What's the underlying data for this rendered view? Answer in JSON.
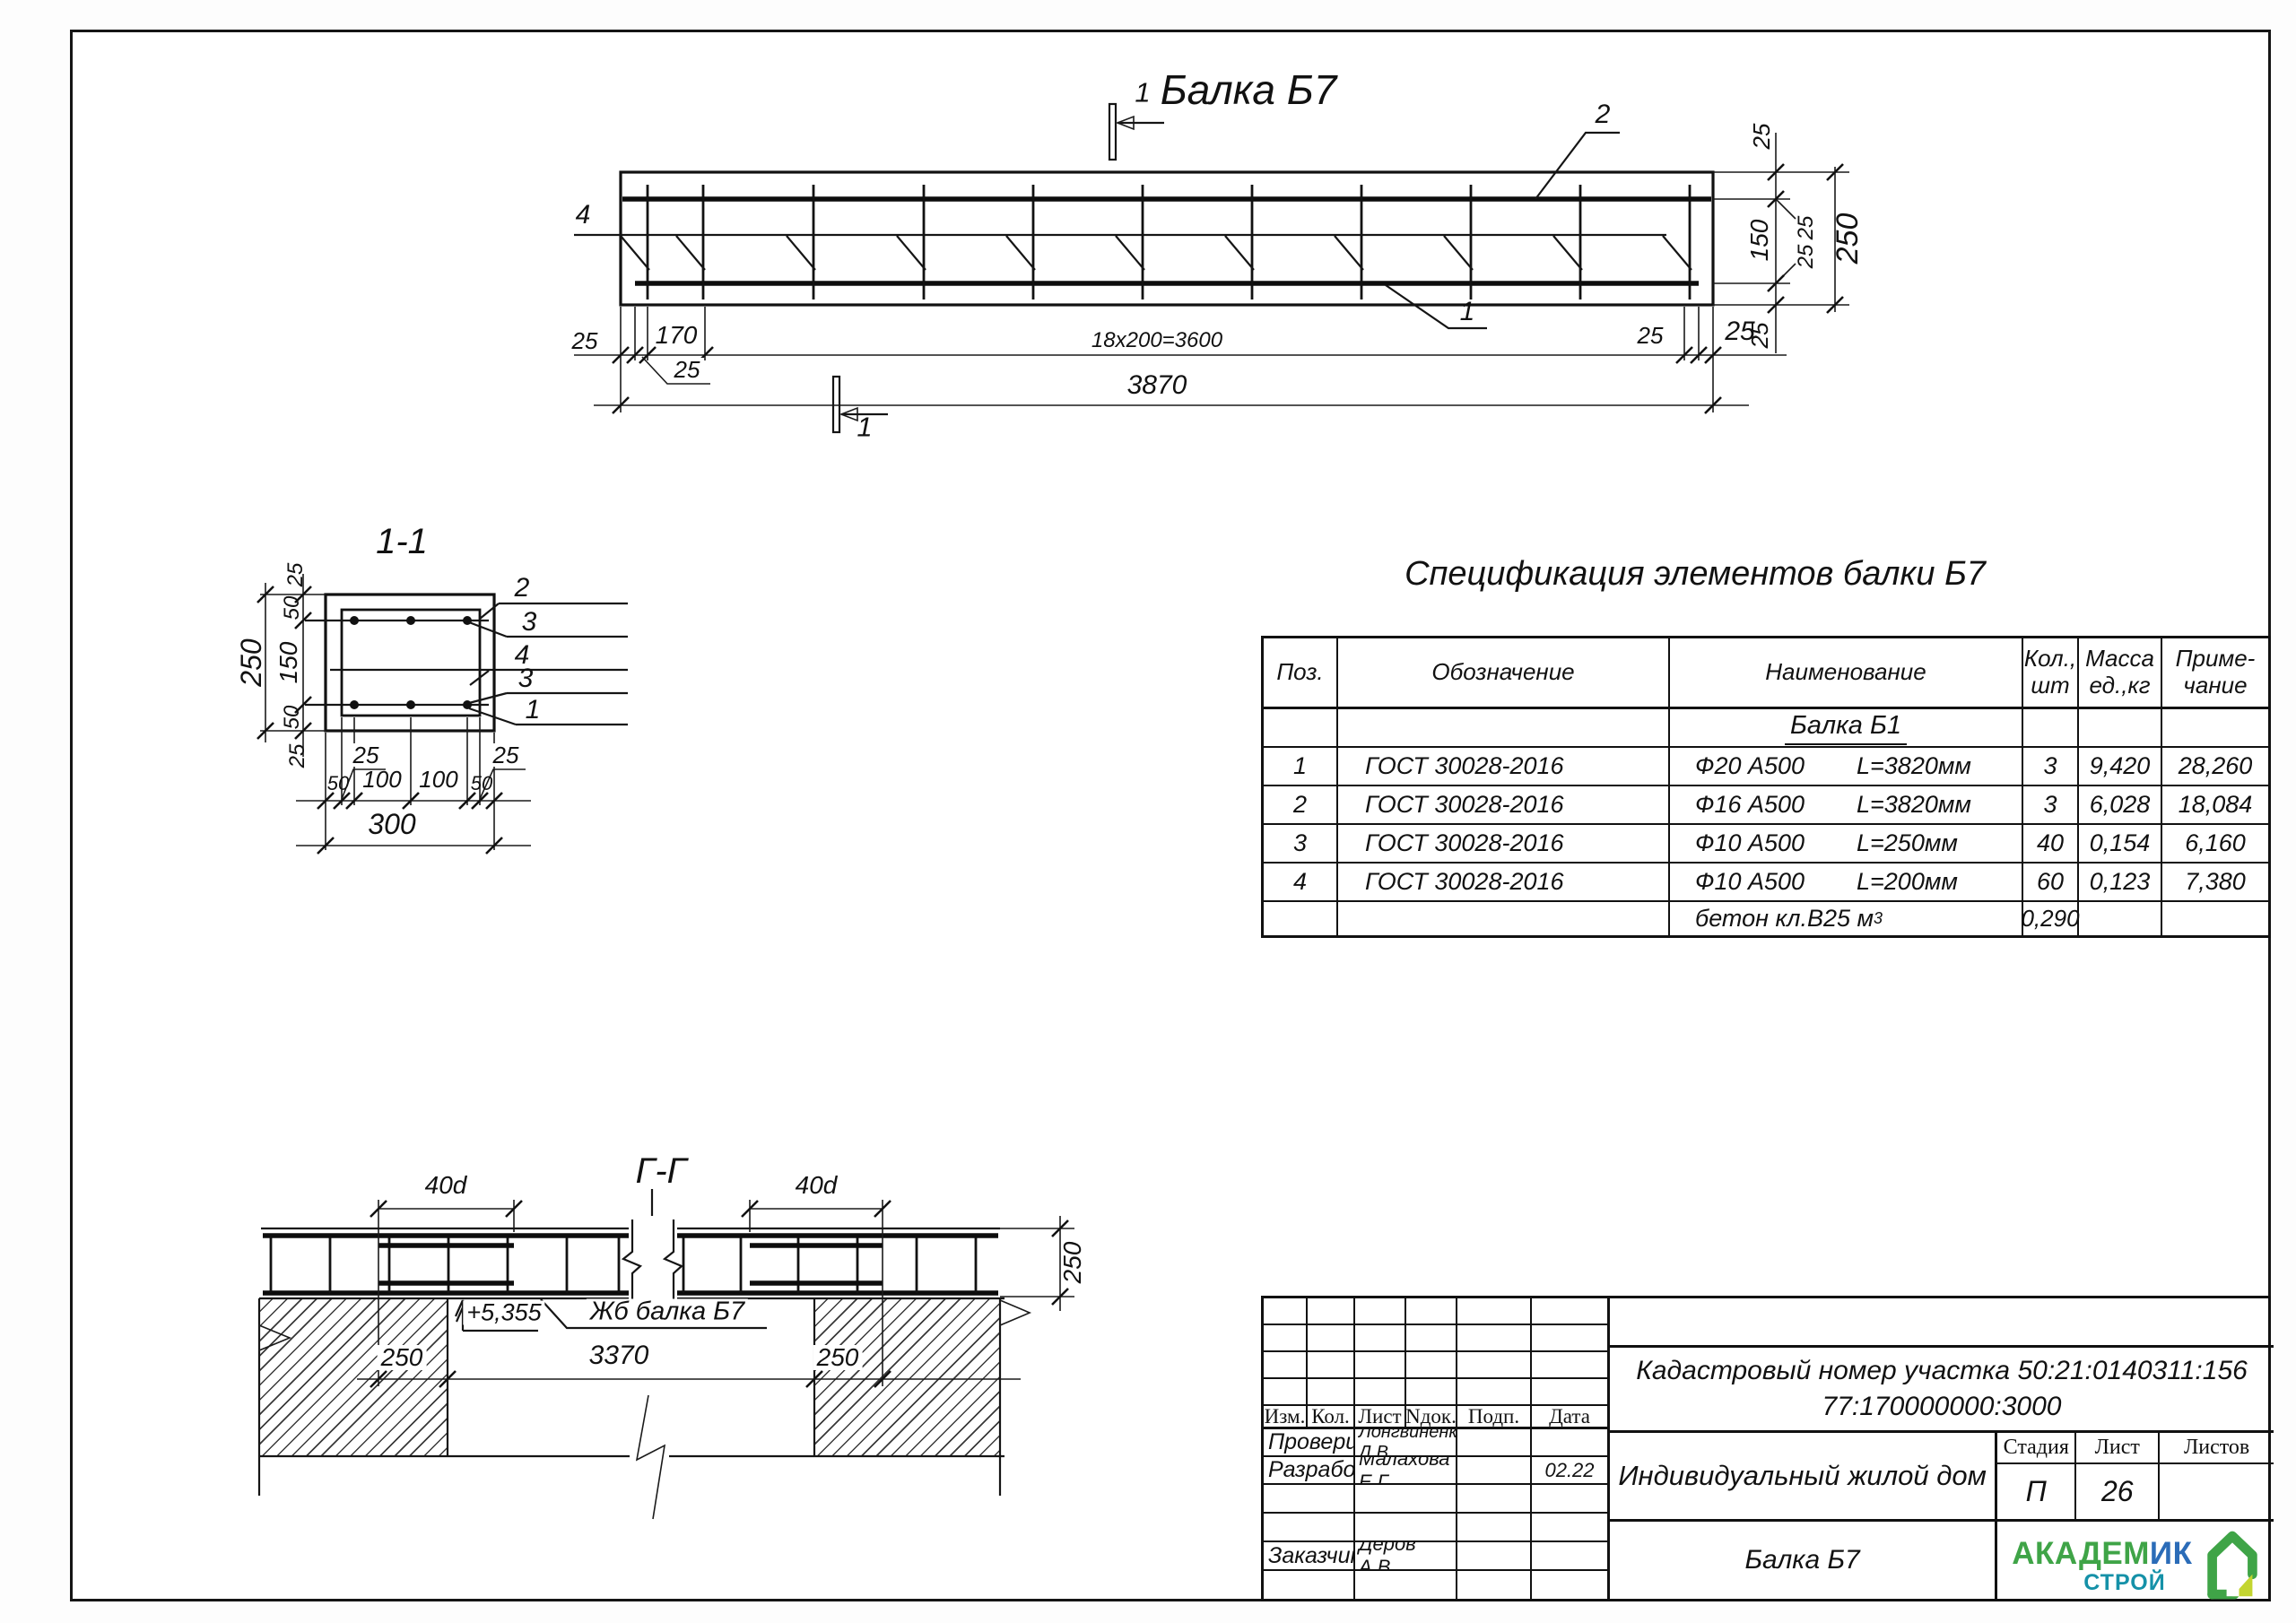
{
  "elevation": {
    "title": "Балка Б7",
    "mark_top": "1",
    "mark_bottom": "1",
    "pos1": "1",
    "pos2": "2",
    "pos4": "4",
    "dim_25_left": "25",
    "dim_170": "170",
    "dim_25_leader": "25",
    "dim_spacing": "18x200=3600",
    "dim_25_right": "25",
    "dim_25_far": "25",
    "dim_total": "3870",
    "rdim_25_above": "25",
    "rdim_25_top": "25",
    "rdim_150": "150",
    "rdim_25_bot": "25",
    "rdim_250": "250",
    "rdim_25_below": "25"
  },
  "section11": {
    "title": "1-1",
    "pos2": "2",
    "pos3a": "3",
    "pos4": "4",
    "pos3b": "3",
    "pos1": "1",
    "left_25_top": "25",
    "left_50_top": "50",
    "left_150": "150",
    "left_50_bot": "50",
    "left_25_bot": "25",
    "left_250": "250",
    "bot_25_left": "25",
    "bot_50_left": "50",
    "bot_100_left": "100",
    "bot_100_right": "100",
    "bot_50_right": "50",
    "bot_25_right": "25",
    "bot_300": "300"
  },
  "gg": {
    "title": "Г-Г",
    "dim_40d_left": "40d",
    "dim_40d_right": "40d",
    "dim_250_side": "250",
    "elevation_mark": "+5,355",
    "beam_label": "Жб балка Б7",
    "dim_250_left": "250",
    "dim_3370": "3370",
    "dim_250_right": "250"
  },
  "spec": {
    "title": "Спецификация элементов балки Б7",
    "col_pos": "Поз.",
    "col_designation": "Обозначение",
    "col_name": "Наименование",
    "col_qty_1": "Кол.,",
    "col_qty_2": "шт",
    "col_mass_1": "Масса",
    "col_mass_2": "ед.,кг",
    "col_note_1": "Приме-",
    "col_note_2": "чание",
    "group": "Балка Б1",
    "rows": [
      {
        "pos": "1",
        "designation": "ГОСТ 30028-2016",
        "name": "Ф20 А500",
        "length": "L=3820мм",
        "qty": "3",
        "mass": "9,420",
        "note": "28,260"
      },
      {
        "pos": "2",
        "designation": "ГОСТ 30028-2016",
        "name": "Ф16 А500",
        "length": "L=3820мм",
        "qty": "3",
        "mass": "6,028",
        "note": "18,084"
      },
      {
        "pos": "3",
        "designation": "ГОСТ 30028-2016",
        "name": "Ф10 А500",
        "length": "L=250мм",
        "qty": "40",
        "mass": "0,154",
        "note": "6,160"
      },
      {
        "pos": "4",
        "designation": "ГОСТ 30028-2016",
        "name": "Ф10 А500",
        "length": "L=200мм",
        "qty": "60",
        "mass": "0,123",
        "note": "7,380"
      }
    ],
    "concrete_name": "бетон кл.В25 м",
    "concrete_sup": "3",
    "concrete_qty": "0,290"
  },
  "titleblock": {
    "h_izm": "Изм.",
    "h_kol": "Кол.",
    "h_list": "Лист",
    "h_ndok": "Nдок.",
    "h_podp": "Подп.",
    "h_data": "Дата",
    "checked_role": "Проверил",
    "checked_name": "Лонгвиненко Д.В",
    "developed_role": "Разработал",
    "developed_name": "Малахова Е.Г.",
    "developed_date": "02.22",
    "customer_role": "Заказчик",
    "customer_name": "Деров А.В.",
    "cadastral1": "Кадастровый номер участка 50:21:0140311:156",
    "cadastral2": "77:170000000:3000",
    "project": "Индивидуальный жилой дом",
    "stage_label": "Стадия",
    "sheet_label": "Лист",
    "sheets_label": "Листов",
    "stage": "П",
    "sheet": "26",
    "sheets": "",
    "doc": "Балка Б7"
  },
  "logo": {
    "part1": "АКАДЕМ",
    "part2": "ИК",
    "line2": "СТРОЙ",
    "green": "#3fa447",
    "blue": "#2b6cb8",
    "teal": "#1591a8",
    "lime": "#c3d530"
  }
}
